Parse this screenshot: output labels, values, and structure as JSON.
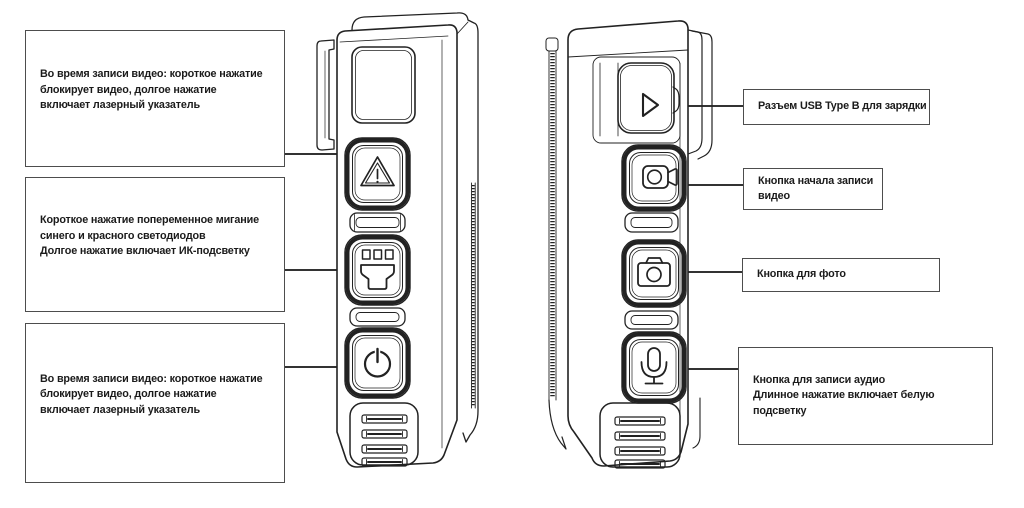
{
  "colors": {
    "background": "#ffffff",
    "line": "#222222",
    "box_border": "#4d4d4d",
    "text": "#1b1b1b",
    "leader": "#333333"
  },
  "left_callouts": [
    {
      "id": "laser-top",
      "text": "Во время записи видео: короткое нажатие\nблокирует видео, долгое нажатие\nвключает лазерный указатель"
    },
    {
      "id": "led-ir",
      "text": "Короткое нажатие попеременное мигание\nсинего и красного светодиодов\nДолгое нажатие включает ИК-подсветку"
    },
    {
      "id": "laser-bottom",
      "text": "Во время записи видео: короткое нажатие\nблокирует видео, долгое нажатие\nвключает лазерный указатель"
    }
  ],
  "right_callouts": [
    {
      "id": "usb",
      "text": "Разъем USB Type B для зарядки"
    },
    {
      "id": "video",
      "text": "Кнопка начала записи\nвидео"
    },
    {
      "id": "photo",
      "text": "Кнопка для фото"
    },
    {
      "id": "audio",
      "text": "Кнопка для записи аудио\nДлинное нажатие включает белую\nподсветку"
    }
  ],
  "left_device": {
    "icons": [
      "laser-warning-triangle-icon",
      "ir-light-icon",
      "power-icon"
    ]
  },
  "right_device": {
    "icons": [
      "usb-flap-triangle-icon",
      "video-record-icon",
      "photo-camera-icon",
      "microphone-icon"
    ]
  }
}
